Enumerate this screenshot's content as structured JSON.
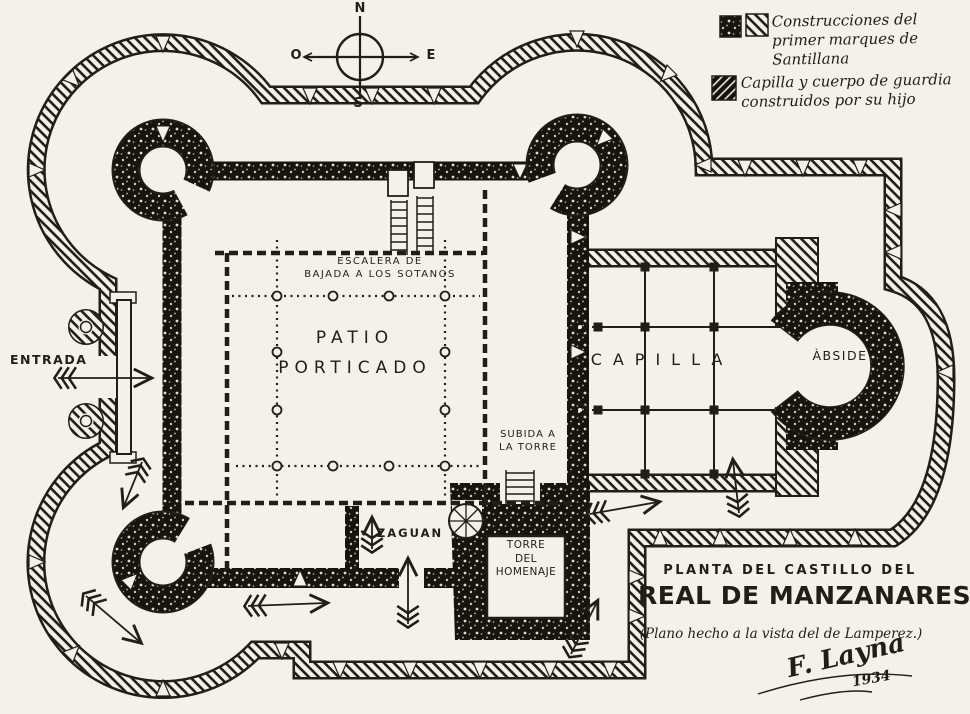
{
  "colors": {
    "paper": "#f3f1ea",
    "ink": "#211d18"
  },
  "compass": {
    "n": "N",
    "e": "E",
    "s": "S",
    "o": "O"
  },
  "legend": {
    "item1": "Construcciones del primer marques de Santillana",
    "item2": "Capilla y cuerpo de guardia construidos por su hijo"
  },
  "labels": {
    "entrada": "ENTRADA",
    "patio1": "PATIO",
    "patio2": "PORTICADO",
    "escalera1": "ESCALERA DE",
    "escalera2": "BAJADA A LOS SOTANOS",
    "subida1": "SUBIDA A",
    "subida2": "LA TORRE",
    "zaguan": "ZAGUAN",
    "torre1": "TORRE",
    "torre2": "DEL",
    "torre3": "HOMENAJE",
    "capilla": "CAPILLA",
    "abside": "ÀBSIDE"
  },
  "title_block": {
    "supertitle": "PLANTA DEL CASTILLO DEL",
    "title": "REAL DE MANZANARES",
    "note": "(Plano hecho a la vista del de Lamperez.)",
    "signature": "F. Layna",
    "year": "1934"
  }
}
